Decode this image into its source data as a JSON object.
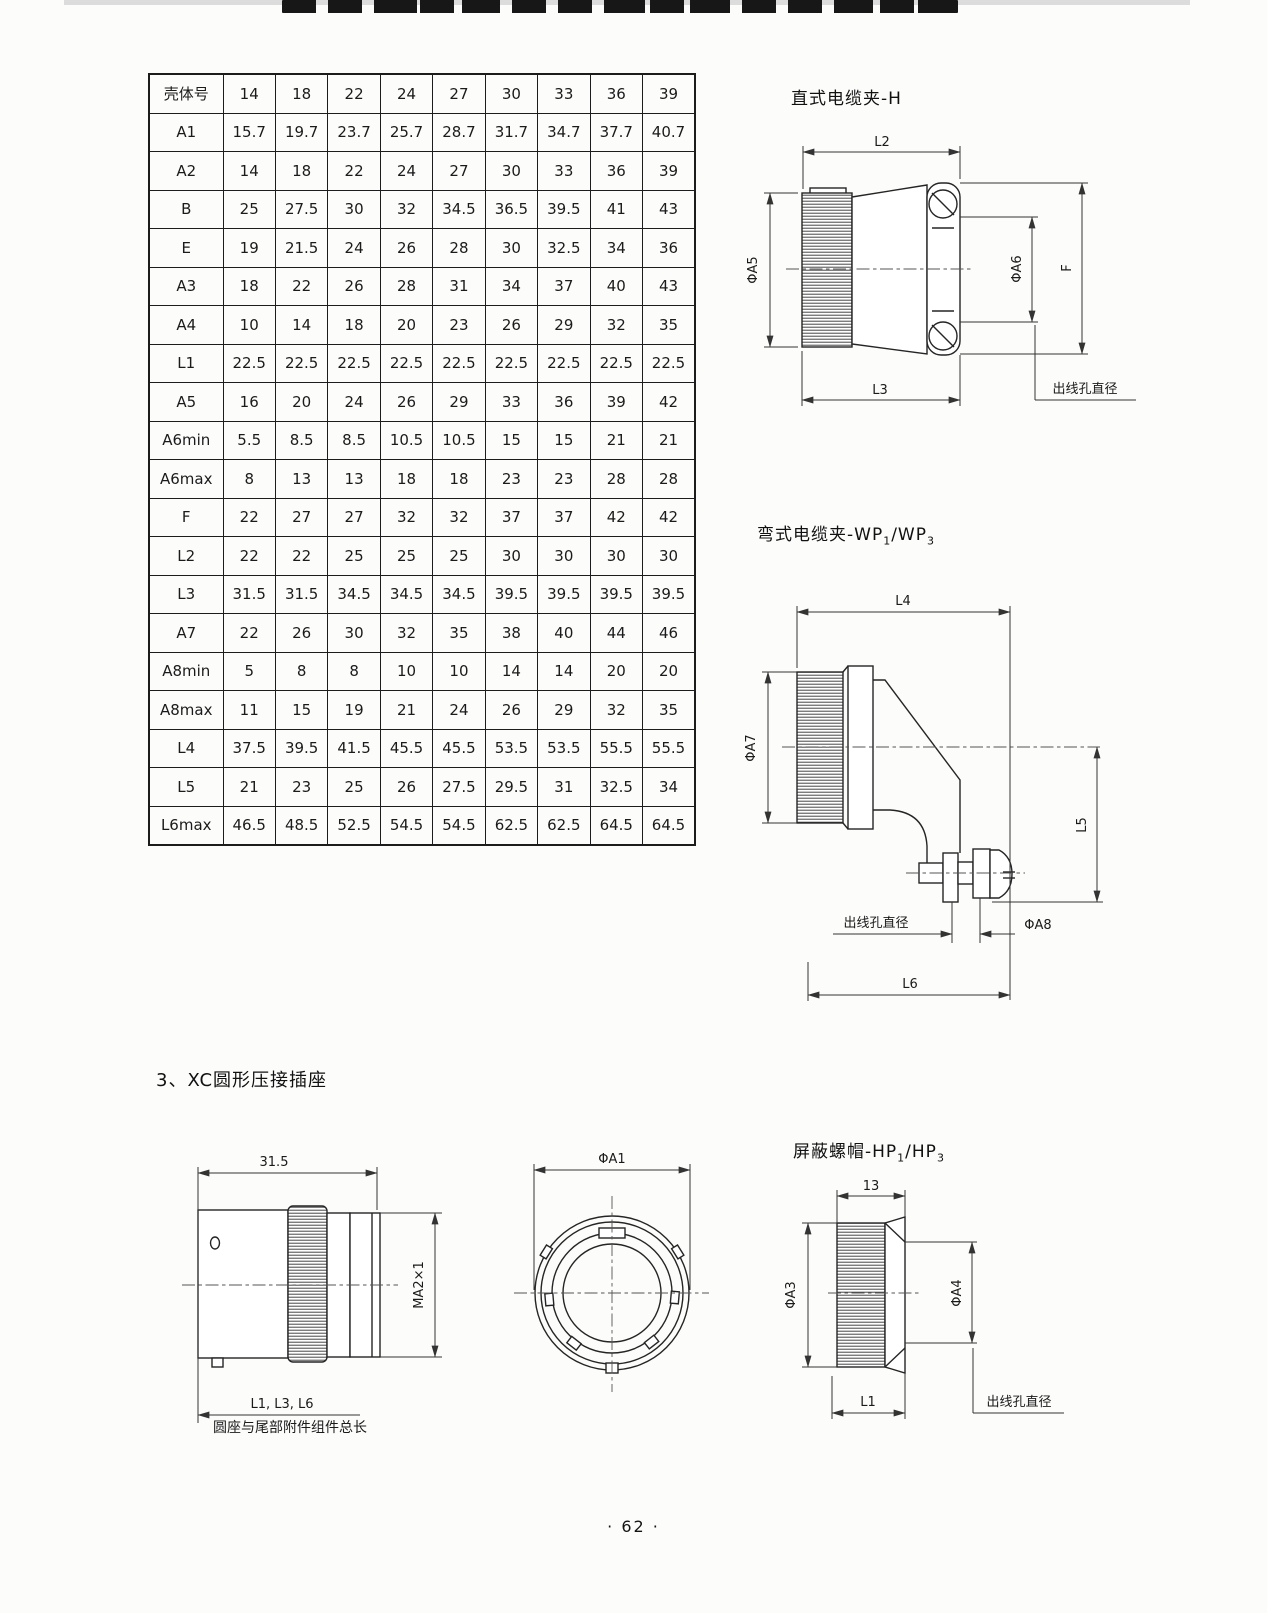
{
  "page": {
    "number": "· 62 ·"
  },
  "table": {
    "header_row": [
      "壳体号",
      "14",
      "18",
      "22",
      "24",
      "27",
      "30",
      "33",
      "36",
      "39"
    ],
    "rows": [
      [
        "A1",
        "15.7",
        "19.7",
        "23.7",
        "25.7",
        "28.7",
        "31.7",
        "34.7",
        "37.7",
        "40.7"
      ],
      [
        "A2",
        "14",
        "18",
        "22",
        "24",
        "27",
        "30",
        "33",
        "36",
        "39"
      ],
      [
        "B",
        "25",
        "27.5",
        "30",
        "32",
        "34.5",
        "36.5",
        "39.5",
        "41",
        "43"
      ],
      [
        "E",
        "19",
        "21.5",
        "24",
        "26",
        "28",
        "30",
        "32.5",
        "34",
        "36"
      ],
      [
        "A3",
        "18",
        "22",
        "26",
        "28",
        "31",
        "34",
        "37",
        "40",
        "43"
      ],
      [
        "A4",
        "10",
        "14",
        "18",
        "20",
        "23",
        "26",
        "29",
        "32",
        "35"
      ],
      [
        "L1",
        "22.5",
        "22.5",
        "22.5",
        "22.5",
        "22.5",
        "22.5",
        "22.5",
        "22.5",
        "22.5"
      ],
      [
        "A5",
        "16",
        "20",
        "24",
        "26",
        "29",
        "33",
        "36",
        "39",
        "42"
      ],
      [
        "A6min",
        "5.5",
        "8.5",
        "8.5",
        "10.5",
        "10.5",
        "15",
        "15",
        "21",
        "21"
      ],
      [
        "A6max",
        "8",
        "13",
        "13",
        "18",
        "18",
        "23",
        "23",
        "28",
        "28"
      ],
      [
        "F",
        "22",
        "27",
        "27",
        "32",
        "32",
        "37",
        "37",
        "42",
        "42"
      ],
      [
        "L2",
        "22",
        "22",
        "25",
        "25",
        "25",
        "30",
        "30",
        "30",
        "30"
      ],
      [
        "L3",
        "31.5",
        "31.5",
        "34.5",
        "34.5",
        "34.5",
        "39.5",
        "39.5",
        "39.5",
        "39.5"
      ],
      [
        "A7",
        "22",
        "26",
        "30",
        "32",
        "35",
        "38",
        "40",
        "44",
        "46"
      ],
      [
        "A8min",
        "5",
        "8",
        "8",
        "10",
        "10",
        "14",
        "14",
        "20",
        "20"
      ],
      [
        "A8max",
        "11",
        "15",
        "19",
        "21",
        "24",
        "26",
        "29",
        "32",
        "35"
      ],
      [
        "L4",
        "37.5",
        "39.5",
        "41.5",
        "45.5",
        "45.5",
        "53.5",
        "53.5",
        "55.5",
        "55.5"
      ],
      [
        "L5",
        "21",
        "23",
        "25",
        "26",
        "27.5",
        "29.5",
        "31",
        "32.5",
        "34"
      ],
      [
        "L6max",
        "46.5",
        "48.5",
        "52.5",
        "54.5",
        "54.5",
        "62.5",
        "62.5",
        "64.5",
        "64.5"
      ]
    ]
  },
  "drawings": {
    "straight_clamp": {
      "title": "直式电缆夹-H",
      "labels": {
        "l2": "L2",
        "a5": "ΦA5",
        "a6": "ΦA6",
        "f": "F",
        "l3": "L3",
        "outlet": "出线孔直径"
      }
    },
    "bent_clamp": {
      "title_main": "弯式电缆夹-WP",
      "title_sub1": "1",
      "title_slash": "/WP",
      "title_sub2": "3",
      "labels": {
        "l4": "L4",
        "a7": "ΦA7",
        "l5": "L5",
        "outlet": "出线孔直径",
        "a8": "ΦA8",
        "l6": "L6"
      }
    },
    "section3_title": "3、XC圆形压接插座",
    "socket_side": {
      "labels": {
        "dim": "31.5",
        "thread": "MA2×1",
        "l": "L1, L3, L6",
        "caption": "圆座与尾部附件组件总长"
      }
    },
    "socket_front": {
      "labels": {
        "a1": "ΦA1"
      }
    },
    "shield_nut": {
      "title_main": "屏蔽螺帽-HP",
      "title_sub1": "1",
      "title_slash": "/HP",
      "title_sub2": "3",
      "labels": {
        "dim": "13",
        "a3": "ΦA3",
        "a4": "ΦA4",
        "l1": "L1",
        "outlet": "出线孔直径"
      }
    }
  }
}
